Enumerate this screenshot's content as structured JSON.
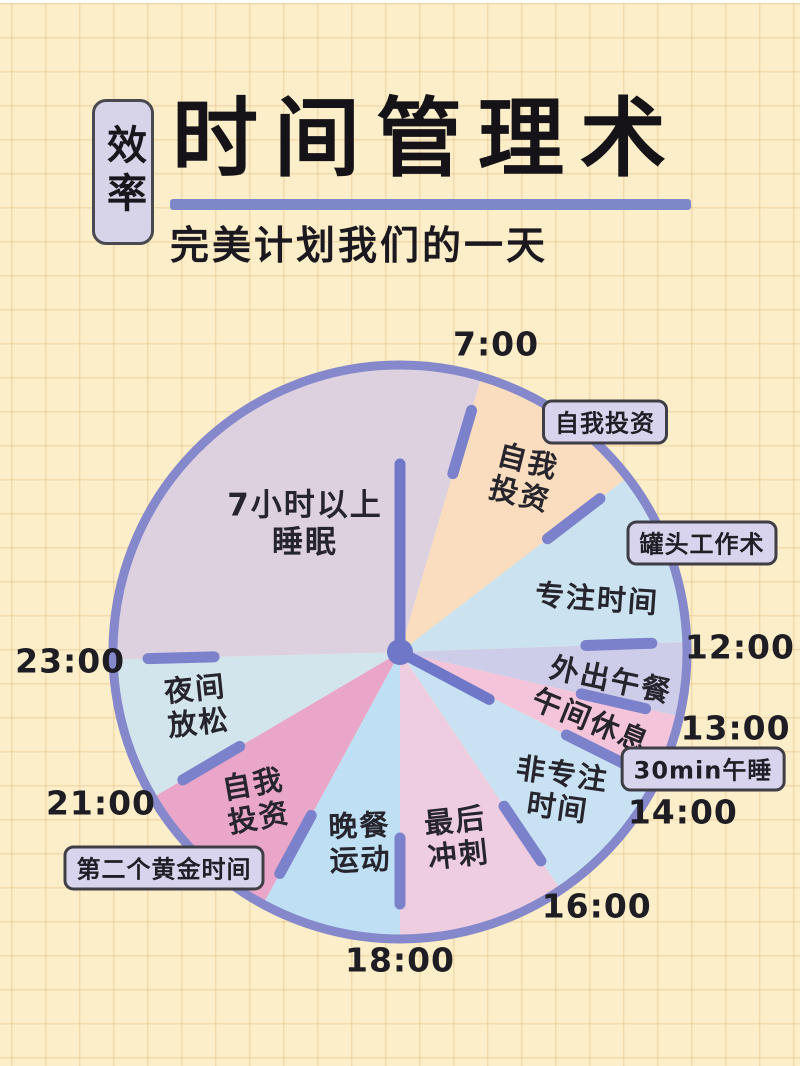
{
  "page": {
    "background_color": "#fceec9",
    "grid_color": "#dbad6a"
  },
  "header": {
    "badge": "效率",
    "badge_bg": "#d7d3e9",
    "title": "时间管理术",
    "underline_color": "#7d88c9",
    "subtitle": "完美计划我们的一天"
  },
  "chart_data": {
    "type": "pie",
    "title": "一天24小时时间规划钟面",
    "legend_position": "none",
    "grid": "graph-paper background",
    "clock_face": {
      "center_x": 400,
      "center_y": 652,
      "radius": 287,
      "rim_color": "#8589cb",
      "rim_width": 9,
      "tick_color": "#7b82cb",
      "tick_inner_r": 186,
      "tick_outer_r": 252,
      "tick_width": 11,
      "hand_color": "#6f77c9",
      "hand_width": 11,
      "center_dot_radius": 13
    },
    "segments": [
      {
        "label": "自我\n投资",
        "time_start": "7:00",
        "time_end": "9:00",
        "hours": 2,
        "start_deg": 16.5,
        "end_deg": 52.5,
        "color": "#fadcbe",
        "label_x": 524,
        "label_y": 478,
        "label_rot": 14
      },
      {
        "label": "专注时间",
        "time_start": "9:00",
        "time_end": "12:00",
        "hours": 3,
        "start_deg": 52.5,
        "end_deg": 88,
        "color": "#cbe3f0",
        "label_x": 597,
        "label_y": 599,
        "label_rot": 4
      },
      {
        "label": "外出午餐",
        "time_start": "12:00",
        "time_end": "13:00",
        "hours": 1,
        "start_deg": 88,
        "end_deg": 103,
        "color": "#cecde9",
        "label_x": 611,
        "label_y": 680,
        "label_rot": 12
      },
      {
        "label": "午间休息",
        "time_start": "13:00",
        "time_end": "14:00",
        "hours": 1,
        "start_deg": 103,
        "end_deg": 116.5,
        "color": "#f4c5da",
        "label_x": 591,
        "label_y": 721,
        "label_rot": 22
      },
      {
        "label": "非专注\n时间",
        "time_start": "14:00",
        "time_end": "16:00",
        "hours": 2,
        "start_deg": 116.5,
        "end_deg": 146,
        "color": "#c9e2f3",
        "label_x": 560,
        "label_y": 791,
        "label_rot": 8
      },
      {
        "label": "最后\n冲刺",
        "time_start": "16:00",
        "time_end": "18:00",
        "hours": 2,
        "start_deg": 146,
        "end_deg": 180,
        "color": "#efcde1",
        "label_x": 457,
        "label_y": 838,
        "label_rot": -6
      },
      {
        "label": "晚餐\n运动",
        "time_start": "18:00",
        "time_end": "20:00",
        "hours": 2,
        "start_deg": 180,
        "end_deg": 208.5,
        "color": "#bedff4",
        "label_x": 360,
        "label_y": 843,
        "label_rot": -2
      },
      {
        "label": "自我\n投资",
        "time_start": "20:00",
        "time_end": "21:00",
        "hours": 1,
        "start_deg": 208.5,
        "end_deg": 239.5,
        "color": "#e9a6c9",
        "label_x": 256,
        "label_y": 801,
        "label_rot": -10
      },
      {
        "label": "夜间\n放松",
        "time_start": "21:00",
        "time_end": "23:00",
        "hours": 2,
        "start_deg": 239.5,
        "end_deg": 268.5,
        "color": "#d3e5ec",
        "label_x": 197,
        "label_y": 706,
        "label_rot": -6
      },
      {
        "label": "7小时以上\n睡眠",
        "time_start": "23:00",
        "time_end": "7:00",
        "hours": 8,
        "start_deg": 268.5,
        "end_deg": 376.5,
        "color": "#ddd1e0",
        "label_x": 305,
        "label_y": 524,
        "label_rot": 0
      }
    ],
    "boundary_tick_degs": [
      16.5,
      52.5,
      88,
      103,
      116.5,
      146,
      180,
      208.5,
      239.5,
      268.5
    ],
    "hands": [
      {
        "deg": 0,
        "length": 188
      },
      {
        "deg": 118,
        "length": 101
      }
    ],
    "time_labels": [
      {
        "text": "7:00",
        "deg": 17.3,
        "r": 323
      },
      {
        "text": "12:00",
        "deg": 89.2,
        "r": 340
      },
      {
        "text": "13:00",
        "deg": 102.7,
        "r": 344
      },
      {
        "text": "14:00",
        "deg": 119.5,
        "r": 325
      },
      {
        "text": "16:00",
        "deg": 142.2,
        "r": 321
      },
      {
        "text": "18:00",
        "deg": 180,
        "r": 308
      },
      {
        "text": "21:00",
        "deg": 243.2,
        "r": 335
      },
      {
        "text": "23:00",
        "deg": 268.4,
        "r": 330
      }
    ],
    "callouts": [
      {
        "text": "自我投资",
        "x": 605,
        "y": 422
      },
      {
        "text": "罐头工作术",
        "x": 702,
        "y": 543
      },
      {
        "text": "30min午睡",
        "x": 703,
        "y": 769
      },
      {
        "text": "第二个黄金时间",
        "x": 164,
        "y": 868
      }
    ]
  }
}
